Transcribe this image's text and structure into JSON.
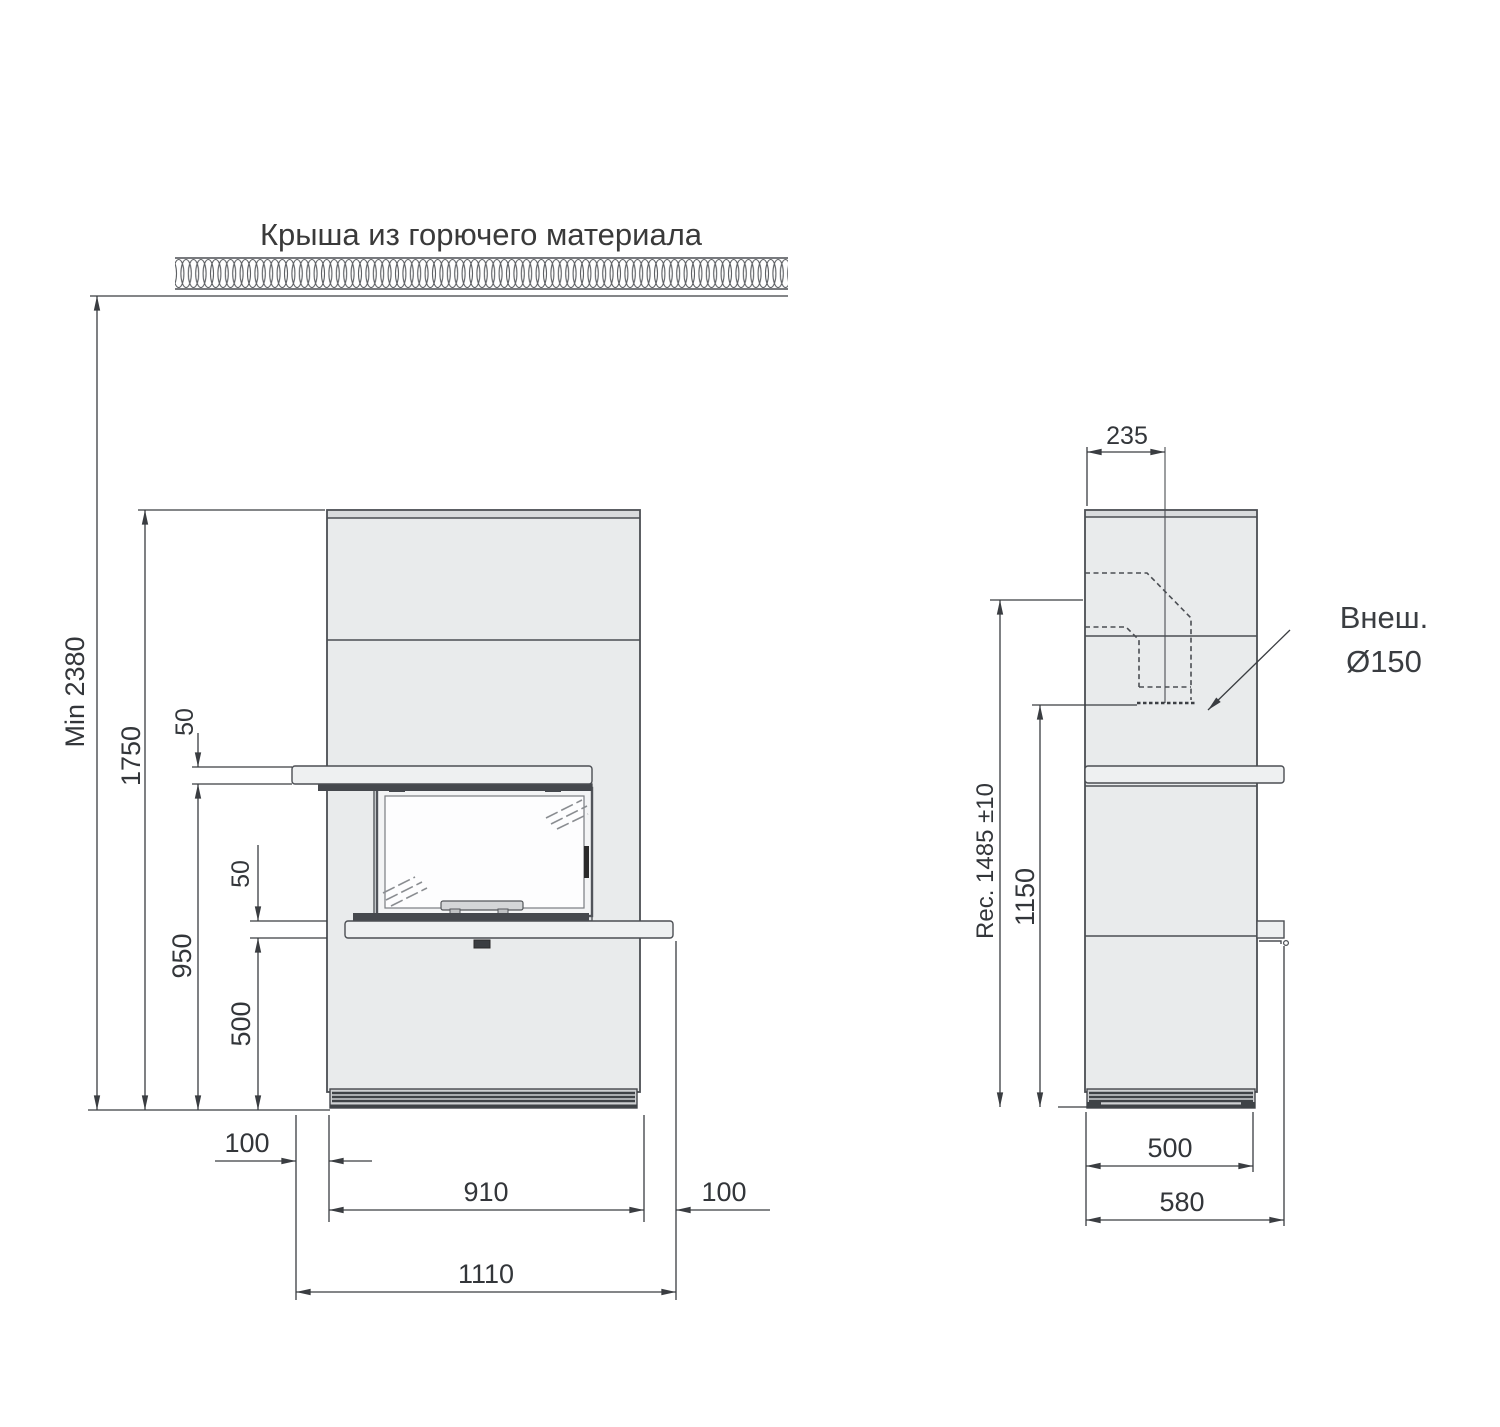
{
  "title": "Крыша из горючего материала",
  "colors": {
    "outline": "#4b4e53",
    "body_fill": "#e9ebec",
    "shelf_fill": "#eef0f1",
    "dark_detail": "#45484d",
    "dimension": "#33363a"
  },
  "front": {
    "min_height": "Min 2380",
    "upper_clearance_height": "1750",
    "mantel_gap": "50",
    "mantel_height": "950",
    "hearth_gap": "50",
    "hearth_height": "500",
    "left_overhang": "100",
    "body_width": "910",
    "right_overhang": "100",
    "total_width": "1110"
  },
  "side": {
    "flue_center_offset": "235",
    "recommended_height": "Rec. 1485 ±10",
    "rear_outlet_height": "1150",
    "body_depth": "500",
    "total_depth": "580",
    "flue_note_line1": "Внеш.",
    "flue_note_line2": "Ø150"
  }
}
